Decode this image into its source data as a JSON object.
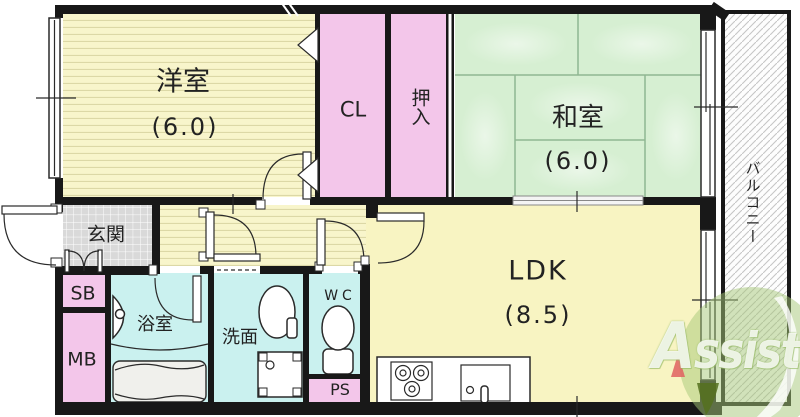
{
  "floor_plan": {
    "rooms": [
      {
        "key": "western-room",
        "label": "洋室",
        "size": "(6.0)"
      },
      {
        "key": "closet",
        "label": "CL",
        "size": ""
      },
      {
        "key": "oshiire",
        "label": "押入",
        "size": ""
      },
      {
        "key": "japanese-room",
        "label": "和室",
        "size": "(6.0)"
      },
      {
        "key": "balcony",
        "label": "バルコニー",
        "size": ""
      },
      {
        "key": "entrance",
        "label": "玄関",
        "size": ""
      },
      {
        "key": "shoe-box",
        "label": "SB",
        "size": ""
      },
      {
        "key": "meter-box",
        "label": "MB",
        "size": ""
      },
      {
        "key": "bathroom",
        "label": "浴室",
        "size": ""
      },
      {
        "key": "washroom",
        "label": "洗面",
        "size": ""
      },
      {
        "key": "toilet",
        "label": "WC",
        "size": ""
      },
      {
        "key": "pipe-space",
        "label": "PS",
        "size": ""
      },
      {
        "key": "living-dining-kitchen",
        "label": "LDK",
        "size": "(8.5)"
      }
    ],
    "watermark": {
      "first_letter": "A",
      "rest": "ssist"
    },
    "colors": {
      "wall": "#181818",
      "flooring_yellow": "#f8f5cb",
      "floor_stripe": "#dcd8a6",
      "ldk_yellow": "#f8f4c2",
      "closet_pink": "#f3c6ea",
      "tatami_green": "#d6efd2",
      "tatami_line": "#8fb792",
      "wet_area_cyan": "#caf1ef",
      "entrance_tile": "#d9d9d9",
      "balcony_hatch": "#c6c6c6",
      "logo_green": "#a6c877",
      "logo_dark_green": "#55701e",
      "logo_red": "#e06060"
    }
  }
}
